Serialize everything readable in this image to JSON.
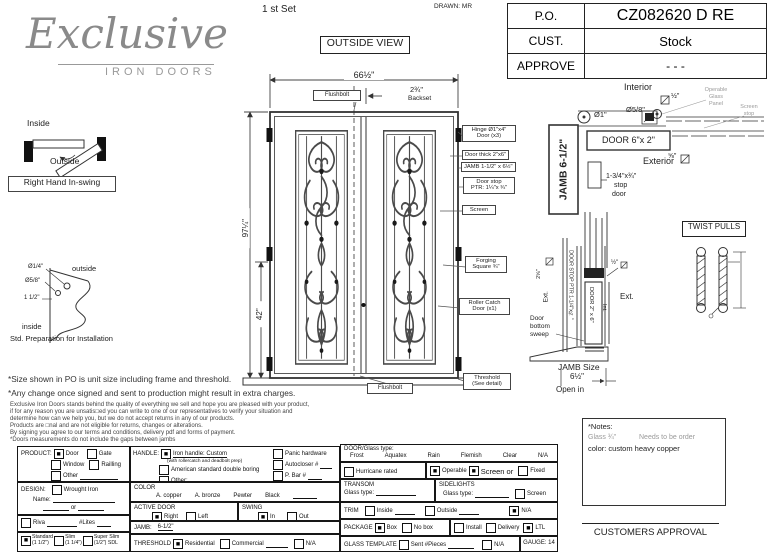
{
  "header": {
    "logo_script": "Exclusive",
    "logo_sub": "IRON DOORS",
    "set_label": "1 st Set",
    "drawn_label": "DRAWN: MR",
    "po": {
      "r1l": "P.O.",
      "r1v": "CZ082620 D RE",
      "r2l": "CUST.",
      "r2v": "Stock",
      "r3l": "APPROVE",
      "r3v": "- - -"
    },
    "outside_view": "OUTSIDE VIEW"
  },
  "swing_diag": {
    "inside": "Inside",
    "outside": "Outside",
    "label": "Right Hand In-swing"
  },
  "prep": {
    "d14": "Ø1/4\"",
    "d58": "Ø5/8\"",
    "d112": "1 1/2\"",
    "outside": "outside",
    "inside": "inside",
    "caption": "Std. Preparation for Installation"
  },
  "door": {
    "width_dim": "66½\"",
    "backset_val": "2¾\"",
    "backset_lbl": "Backset",
    "flushbolt_top": "Flushbolt",
    "flushbolt_bottom": "Flushbolt",
    "height_dim": "97¼\"",
    "lock_dim": "42\"",
    "hinge1": "Hinge Ø1\"x4\"",
    "hinge2": "Door (x3)",
    "thick": "Door thick 2\"x6\"",
    "jamb": "JAMB  1-1/2\" x 6½\"",
    "stop1": "Door stop",
    "stop2": "PTR: 1¼\"x ¾\"",
    "screen": "Screen",
    "forging1": "Forging",
    "forging2": "Square ¾\"",
    "roller1": "Roller Catch",
    "roller2": "Door (x1)",
    "thresh1": "Threshold",
    "thresh2": "(See detail)"
  },
  "sec_top": {
    "interior": "Interior",
    "half": "½\"",
    "dia1": "Ø1\"",
    "dia58": "Ø5/8\"",
    "op1": "Operable",
    "op2": "Glass",
    "op3": "Panel",
    "ss1": "Screen",
    "ss2": "stop",
    "door62": "DOOR 6\"x 2\"",
    "jamb65": "JAMB 6-1/2\"",
    "exterior": "Exterior",
    "fe": "⅝\"",
    "sd1": "1-3/4\"x¾\"",
    "sd2": "stop",
    "sd3": "door"
  },
  "sec_bot": {
    "d258": "2⅝\"",
    "ext1": "Ext.",
    "dstop": "DOOR STOP PTR 1-1/4\"x¾\"",
    "d26": "DOOR 2\" x 6\"",
    "int": "Int.",
    "half": "½\"",
    "ext2": "Ext.",
    "sw1": "Door",
    "sw2": "bottom",
    "sw3": "sweep",
    "js": "JAMB Size",
    "jsv": "6½\"",
    "open": "Open in"
  },
  "twist": "TWIST PULLS",
  "disc": {
    "l1": "*Size shown in PO is unit size including frame and threshold.",
    "l2": "*Any change once signed and sent to production might result in extra charges.",
    "l3": "Exclusive Iron Doors stands behind the quality of everything we sell and hope you are pleased with your product,",
    "l4": "if for any reason you are unsatis□ed you can write to one of our representatives to verify your situation and",
    "l5": "determine how can we help you, but we do not accept returns in any of our products.",
    "l6": "Products are □nal and are not eligible for returns, changes or alterations.",
    "l7": "By signing you agree to our terms and conditions, delivery pdf and forms of payment.",
    "l8": "*Doors measurements do not include the gaps between jambs"
  },
  "notes": {
    "title": "*Notes:",
    "g1": "Glass ¾\"",
    "g2": "Needs to be order",
    "c1": "color: custom heavy copper"
  },
  "approval": "CUSTOMERS APPROVAL",
  "form": {
    "product": {
      "label": "PRODUCT:",
      "door": "Door",
      "door_c": "■",
      "gate": "Gate",
      "gate_c": "",
      "window": "Window",
      "window_c": "",
      "railling": "Railling",
      "railling_c": "",
      "other": "Other",
      "other_c": ""
    },
    "design": {
      "label": "DESIGN:",
      "wrought": "Wrought Iron",
      "wrought_c": "",
      "name": "Name:",
      "or": "or"
    },
    "riva": {
      "riva": "Riva",
      "riva_c": "",
      "lites": "#Lites"
    },
    "sizes": {
      "std": "Standard",
      "std_sub": "(1 1/2\")",
      "std_c": "■",
      "slim": "Slim",
      "slim_sub": "(1 1/4\")",
      "slim_c": "",
      "super": "Super Slim",
      "super_sub": "(1/2\") SDL",
      "super_c": ""
    },
    "handle": {
      "label": "HANDLE:",
      "iron": "Iron handle: Custom",
      "iron_c": "■",
      "iron_sub": "(with rollercatch and deadbolt prep)",
      "amer": "American standard double boring",
      "amer_c": "",
      "other": "Other:",
      "other_c": "",
      "panic": "Panic hardware",
      "panic_c": "",
      "auto": "Autocloser #",
      "auto_c": "",
      "pbar": "P. Bar #",
      "pbar_c": ""
    },
    "color": {
      "label": "COLOR",
      "o1": "A. copper",
      "o2": "A. bronze",
      "o3": "Pewter",
      "o4": "Black"
    },
    "active": {
      "label": "ACTIVE DOOR",
      "right": "Right",
      "right_c": "■",
      "left": "Left",
      "left_c": ""
    },
    "swing": {
      "label": "SWING",
      "in": "In",
      "in_c": "■",
      "out": "Out",
      "out_c": ""
    },
    "jamb": {
      "label": "JAMB:",
      "value": "6-1/2\""
    },
    "threshold": {
      "label": "THRESHOLD",
      "res": "Residential",
      "res_c": "■",
      "com": "Commercial",
      "com_c": "",
      "na": "N/A",
      "na_c": ""
    },
    "glass": {
      "label": "DOOR/Glass type:",
      "t1": "Frost",
      "t2": "Aquatex",
      "t3": "Rain",
      "t4": "Flemish",
      "t5": "Clear",
      "t6": "N/A"
    },
    "rated": {
      "hurricane": "Hurricane rated",
      "hurricane_c": "",
      "operable": "Operable",
      "operable_c": "■",
      "screen_or": "Screen or",
      "screen_c": "■",
      "fixed": "Fixed",
      "fixed_c": ""
    },
    "transom": {
      "label": "TRANSOM",
      "glass": "Glass type:"
    },
    "sidelights": {
      "label": "SIDELIGHTS",
      "glass": "Glass type:",
      "screen": "Screen",
      "screen_c": ""
    },
    "trim": {
      "label": "TRIM",
      "inside": "Inside",
      "inside_c": "",
      "outside": "Outside",
      "outside_c": "",
      "na": "N/A",
      "na_c": "■"
    },
    "package": {
      "label": "PACKAGE",
      "box": "Box",
      "box_c": "■",
      "nobox": "No box",
      "nobox_c": "",
      "install": "Install",
      "install_c": "",
      "delivery": "Delivery",
      "delivery_c": "",
      "ltl": "LTL",
      "ltl_c": "■"
    },
    "template": {
      "label": "GLASS TEMPLATE",
      "sent": "Sent #Pieces",
      "sent_c": "",
      "na": "N/A",
      "na_c": "",
      "gauge": "GAUGE: 14"
    }
  }
}
